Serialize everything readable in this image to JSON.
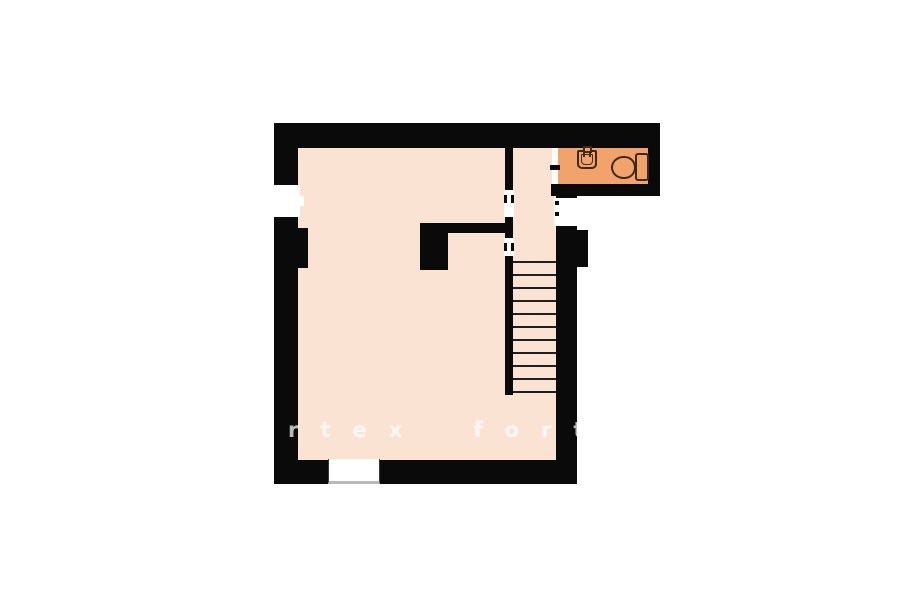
{
  "watermark": {
    "text": "rtex fort"
  },
  "colors": {
    "wall": "#0a0a0a",
    "floor": "#fbe3d4",
    "bathroom_floor": "#f2a36b",
    "fixture_outline": "#3d2b17",
    "tread_line": "#1f1f1f",
    "background": "#ffffff"
  },
  "plan": {
    "type": "floor-plan",
    "rooms": [
      {
        "name": "main-room"
      },
      {
        "name": "stair-hall"
      },
      {
        "name": "bathroom"
      }
    ],
    "stairs": {
      "tread_count": 11,
      "orientation": "vertical"
    },
    "fixtures": [
      "sink",
      "toilet"
    ],
    "openings": [
      "left-window",
      "east-window",
      "entry-door",
      "stair-hall-doorway-upper",
      "stair-hall-doorway-lower",
      "bathroom-doorway"
    ]
  }
}
